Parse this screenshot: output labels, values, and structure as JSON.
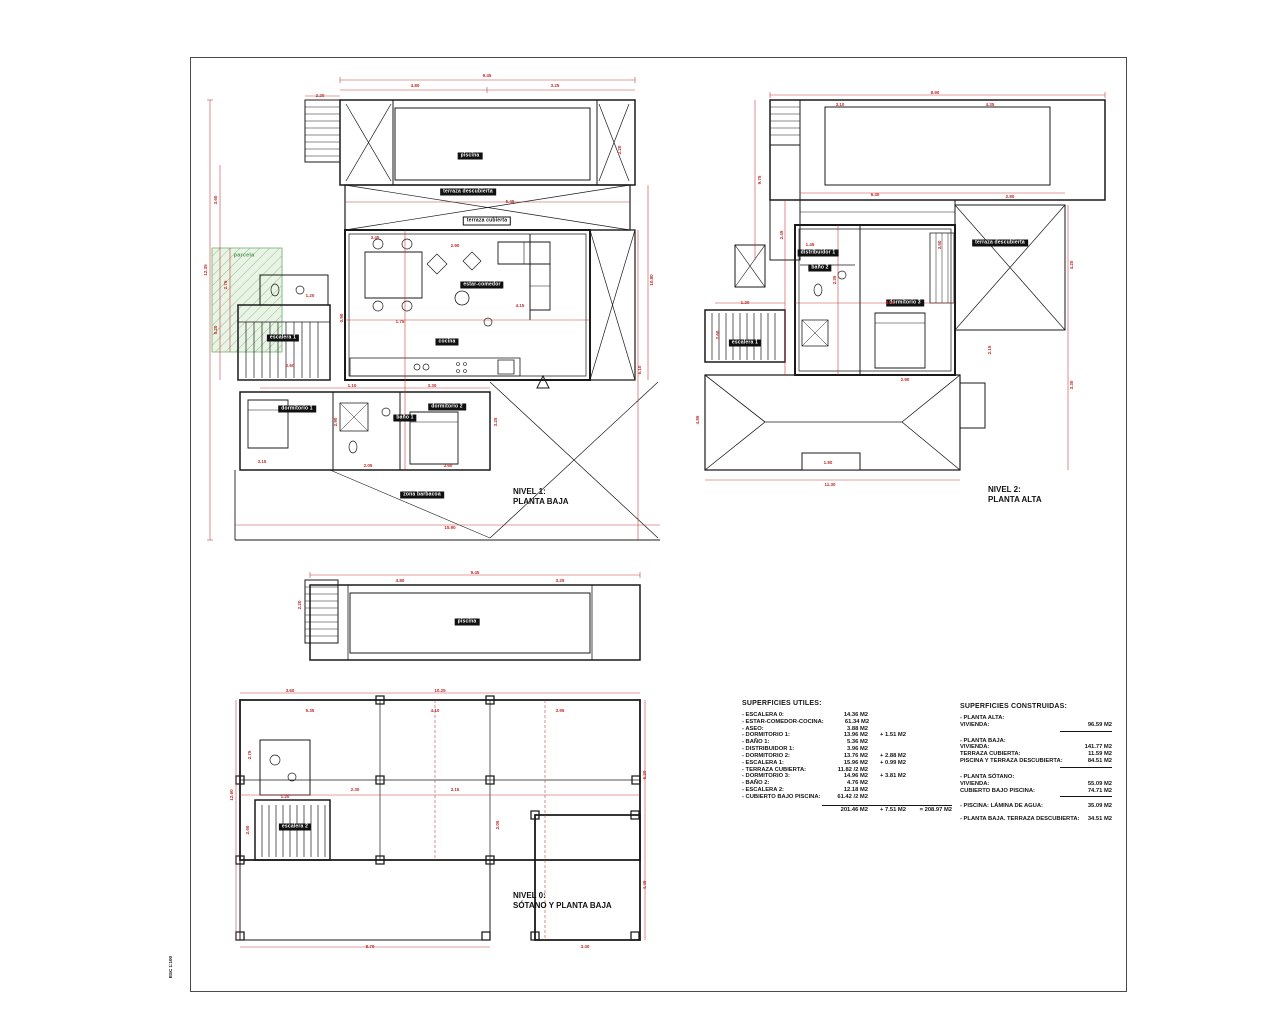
{
  "sheet": {
    "background": "#ffffff",
    "frame_color": "#4a4a4a",
    "line_color": "#1a1a1a",
    "dim_color": "#c02b2b",
    "green_color": "#4f9b4f",
    "stamp_text": "ESC 1:100"
  },
  "plans": [
    {
      "id": "nivel1",
      "title": "NIVEL 1:\nPLANTA BAJA",
      "title_pos": {
        "x": 313,
        "y": 417
      },
      "tags": [
        {
          "text": "piscina",
          "x": 270,
          "y": 86,
          "style": "solid"
        },
        {
          "text": "terraza descubierta",
          "x": 268,
          "y": 122,
          "style": "solid"
        },
        {
          "text": "terraza cubierta",
          "x": 287,
          "y": 151,
          "style": "outline"
        },
        {
          "text": "estar-comedor",
          "x": 282,
          "y": 215,
          "style": "solid"
        },
        {
          "text": "cocina",
          "x": 247,
          "y": 272,
          "style": "solid"
        },
        {
          "text": "escalera 1",
          "x": 83,
          "y": 268,
          "style": "solid"
        },
        {
          "text": "dormitorio 1",
          "x": 97,
          "y": 339,
          "style": "solid"
        },
        {
          "text": "baño 1",
          "x": 205,
          "y": 348,
          "style": "solid"
        },
        {
          "text": "dormitorio 2",
          "x": 247,
          "y": 337,
          "style": "solid"
        },
        {
          "text": "zona barbacoa",
          "x": 222,
          "y": 425,
          "style": "solid"
        },
        {
          "text": "parcela",
          "x": 44,
          "y": 186,
          "style": "green"
        }
      ],
      "dims": [
        {
          "t": "9.45",
          "x": 287,
          "y": 6
        },
        {
          "t": "4.80",
          "x": 215,
          "y": 16
        },
        {
          "t": "3.25",
          "x": 355,
          "y": 16
        },
        {
          "t": "2.20",
          "x": 120,
          "y": 26
        },
        {
          "t": "12.35",
          "x": 6,
          "y": 200,
          "v": 1
        },
        {
          "t": "3.60",
          "x": 16,
          "y": 130,
          "v": 1
        },
        {
          "t": "5.20",
          "x": 16,
          "y": 260,
          "v": 1
        },
        {
          "t": "2.75",
          "x": 26,
          "y": 215,
          "v": 1
        },
        {
          "t": "10.80",
          "x": 452,
          "y": 210,
          "v": 1
        },
        {
          "t": "6.10",
          "x": 440,
          "y": 300,
          "v": 1
        },
        {
          "t": "2.20",
          "x": 420,
          "y": 80,
          "v": 1
        },
        {
          "t": "15.90",
          "x": 250,
          "y": 458
        },
        {
          "t": "3.45",
          "x": 175,
          "y": 168
        },
        {
          "t": "2.90",
          "x": 255,
          "y": 176
        },
        {
          "t": "5.45",
          "x": 310,
          "y": 132
        },
        {
          "t": "1.75",
          "x": 200,
          "y": 252
        },
        {
          "t": "4.15",
          "x": 320,
          "y": 236
        },
        {
          "t": "2.60",
          "x": 90,
          "y": 296
        },
        {
          "t": "1.10",
          "x": 152,
          "y": 316
        },
        {
          "t": "3.30",
          "x": 232,
          "y": 316
        },
        {
          "t": "3.15",
          "x": 62,
          "y": 392
        },
        {
          "t": "2.05",
          "x": 168,
          "y": 396
        },
        {
          "t": "3.60",
          "x": 248,
          "y": 396
        },
        {
          "t": "2.90",
          "x": 136,
          "y": 352,
          "v": 1
        },
        {
          "t": "3.25",
          "x": 296,
          "y": 352,
          "v": 1
        },
        {
          "t": "1.20",
          "x": 110,
          "y": 226
        },
        {
          "t": "0.90",
          "x": 142,
          "y": 248,
          "v": 1
        }
      ]
    },
    {
      "id": "nivel2",
      "title": "NIVEL 2:\nPLANTA ALTA",
      "title_pos": {
        "x": 298,
        "y": 400
      },
      "tags": [
        {
          "text": "terraza descubierta",
          "x": 310,
          "y": 158,
          "style": "solid"
        },
        {
          "text": "dormitorio 3",
          "x": 215,
          "y": 218,
          "style": "solid"
        },
        {
          "text": "baño 2",
          "x": 130,
          "y": 183,
          "style": "solid"
        },
        {
          "text": "distribuidor 1",
          "x": 128,
          "y": 168,
          "style": "solid"
        },
        {
          "text": "escalera 1",
          "x": 55,
          "y": 258,
          "style": "solid"
        }
      ],
      "dims": [
        {
          "t": "8.90",
          "x": 245,
          "y": 8
        },
        {
          "t": "3.10",
          "x": 150,
          "y": 20
        },
        {
          "t": "4.35",
          "x": 300,
          "y": 20
        },
        {
          "t": "9.75",
          "x": 70,
          "y": 95,
          "v": 1
        },
        {
          "t": "2.45",
          "x": 92,
          "y": 150,
          "v": 1
        },
        {
          "t": "6.40",
          "x": 185,
          "y": 110
        },
        {
          "t": "2.80",
          "x": 320,
          "y": 112
        },
        {
          "t": "4.20",
          "x": 382,
          "y": 180,
          "v": 1
        },
        {
          "t": "3.30",
          "x": 382,
          "y": 300,
          "v": 1
        },
        {
          "t": "1.45",
          "x": 120,
          "y": 160
        },
        {
          "t": "2.35",
          "x": 145,
          "y": 195,
          "v": 1
        },
        {
          "t": "3.05",
          "x": 200,
          "y": 218
        },
        {
          "t": "3.50",
          "x": 250,
          "y": 160,
          "v": 1
        },
        {
          "t": "2.90",
          "x": 215,
          "y": 295
        },
        {
          "t": "1.20",
          "x": 55,
          "y": 218
        },
        {
          "t": "2.60",
          "x": 28,
          "y": 250,
          "v": 1
        },
        {
          "t": "11.30",
          "x": 140,
          "y": 400
        },
        {
          "t": "4.85",
          "x": 8,
          "y": 335,
          "v": 1
        },
        {
          "t": "1.80",
          "x": 138,
          "y": 378
        },
        {
          "t": "2.15",
          "x": 300,
          "y": 265,
          "v": 1
        }
      ]
    },
    {
      "id": "nivel0",
      "title": "NIVEL 0:\nSÓTANO Y PLANTA BAJA",
      "title_pos": {
        "x": 283,
        "y": 326
      },
      "tags": [
        {
          "text": "piscina",
          "x": 237,
          "y": 57,
          "style": "solid"
        },
        {
          "text": "escalera 2",
          "x": 65,
          "y": 262,
          "style": "solid"
        }
      ],
      "dims": [
        {
          "t": "9.45",
          "x": 245,
          "y": 8
        },
        {
          "t": "2.20",
          "x": 70,
          "y": 40,
          "v": 1
        },
        {
          "t": "4.80",
          "x": 170,
          "y": 16
        },
        {
          "t": "3.25",
          "x": 330,
          "y": 16
        },
        {
          "t": "10.25",
          "x": 210,
          "y": 126
        },
        {
          "t": "3.60",
          "x": 60,
          "y": 126
        },
        {
          "t": "12.60",
          "x": 2,
          "y": 230,
          "v": 1
        },
        {
          "t": "2.75",
          "x": 20,
          "y": 190,
          "v": 1
        },
        {
          "t": "5.35",
          "x": 80,
          "y": 146
        },
        {
          "t": "4.10",
          "x": 205,
          "y": 146
        },
        {
          "t": "3.95",
          "x": 330,
          "y": 146
        },
        {
          "t": "6.20",
          "x": 415,
          "y": 210,
          "v": 1
        },
        {
          "t": "4.45",
          "x": 415,
          "y": 320,
          "v": 1
        },
        {
          "t": "2.30",
          "x": 125,
          "y": 225
        },
        {
          "t": "3.15",
          "x": 225,
          "y": 225
        },
        {
          "t": "1.20",
          "x": 55,
          "y": 232
        },
        {
          "t": "2.60",
          "x": 18,
          "y": 265,
          "v": 1
        },
        {
          "t": "8.70",
          "x": 140,
          "y": 382
        },
        {
          "t": "3.40",
          "x": 355,
          "y": 382
        },
        {
          "t": "2.05",
          "x": 268,
          "y": 260,
          "v": 1
        }
      ]
    }
  ],
  "superficies_utiles": {
    "title": "SUPERFICIES UTILES:",
    "rows": [
      {
        "label": "- ESCALERA 0:",
        "v1": "14.36 M2",
        "v2": ""
      },
      {
        "label": "- ESTAR-COMEDOR-COCINA:",
        "v1": "61.34 M2",
        "v2": ""
      },
      {
        "label": "- ASEO:",
        "v1": "3.88 M2",
        "v2": ""
      },
      {
        "label": "- DORMITORIO 1:",
        "v1": "13.96 M2",
        "v2": "+ 1.51 M2"
      },
      {
        "label": "- BAÑO 1:",
        "v1": "5.36 M2",
        "v2": ""
      },
      {
        "label": "- DISTRIBUIDOR 1:",
        "v1": "3.96 M2",
        "v2": ""
      },
      {
        "label": "- DORMITORIO 2:",
        "v1": "13.76 M2",
        "v2": "+ 2.88 M2"
      },
      {
        "label": "- ESCALERA 1:",
        "v1": "15.96 M2",
        "v2": "+ 0.99 M2"
      },
      {
        "label": "- TERRAZA CUBIERTA:",
        "v1": "11.82 /2 M2",
        "v2": ""
      },
      {
        "label": "- DORMITORIO 3:",
        "v1": "14.96 M2",
        "v2": "+ 3.81 M2"
      },
      {
        "label": "- BAÑO 2:",
        "v1": "4.76 M2",
        "v2": ""
      },
      {
        "label": "- ESCALERA 2:",
        "v1": "12.18 M2",
        "v2": ""
      },
      {
        "label": "- CUBIERTO BAJO PISCINA:",
        "v1": "61.42 /2 M2",
        "v2": ""
      }
    ],
    "totals": {
      "v1": "201.46 M2",
      "v2": "+ 7.51 M2",
      "v3": "= 208.97 M2"
    }
  },
  "superficies_construidas": {
    "title": "SUPERFICIES CONSTRUIDAS:",
    "groups": [
      {
        "header": "- PLANTA ALTA:",
        "rows": [
          {
            "label": "VIVIENDA:",
            "value": "96.59 M2"
          }
        ],
        "sum_line": true
      },
      {
        "header": "- PLANTA BAJA:",
        "rows": [
          {
            "label": "VIVIENDA:",
            "value": "141.77 M2"
          },
          {
            "label": "TERRAZA CUBIERTA:",
            "value": "11.59 M2"
          },
          {
            "label": "PISCINA Y TERRAZA DESCUBIERTA:",
            "value": "84.51 M2"
          }
        ],
        "sum_line": true
      },
      {
        "header": "- PLANTA SÓTANO:",
        "rows": [
          {
            "label": "VIVIENDA:",
            "value": "55.09 M2"
          },
          {
            "label": "CUBIERTO BAJO PISCINA:",
            "value": "74.71 M2"
          }
        ],
        "sum_line": true
      },
      {
        "header": "",
        "rows": [
          {
            "label": "- PISCINA: LÁMINA DE AGUA:",
            "value": "35.09 M2"
          }
        ],
        "sum_line": false
      },
      {
        "header": "",
        "rows": [
          {
            "label": "- PLANTA BAJA. TERRAZA DESCUBIERTA:",
            "value": "34.51 M2"
          }
        ],
        "sum_line": false
      }
    ]
  }
}
